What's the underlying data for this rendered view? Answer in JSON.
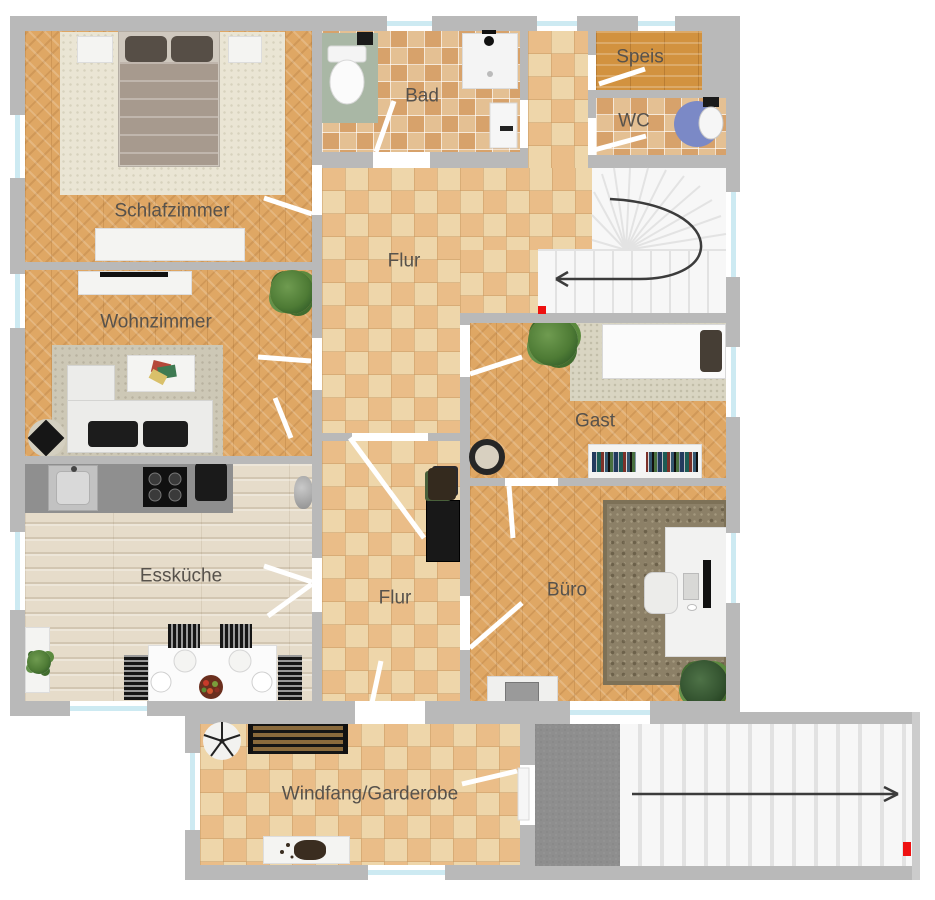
{
  "title": "Erdgeschoss Grundriss",
  "rooms": {
    "schlafzimmer": {
      "label": "Schlafzimmer"
    },
    "wohnzimmer": {
      "label": "Wohnzimmer"
    },
    "esskueche": {
      "label": "Essküche"
    },
    "flur_oben": {
      "label": "Flur"
    },
    "flur_unten": {
      "label": "Flur"
    },
    "bad": {
      "label": "Bad"
    },
    "speis": {
      "label": "Speis"
    },
    "wc": {
      "label": "WC"
    },
    "gast": {
      "label": "Gast"
    },
    "buero": {
      "label": "Büro"
    },
    "windfang": {
      "label": "Windfang/Garderobe"
    }
  },
  "stairs": {
    "upper": {
      "icon": "curved-arrow-left",
      "marker": "red-entry-marker"
    },
    "lower": {
      "icon": "arrow-right",
      "marker": "red-entry-marker"
    }
  },
  "colors": {
    "wall": "#b9b9b9",
    "wall_light": "#cccccc",
    "window_glass": "#cdeaf2",
    "floor_tile_light": "#eed6aa",
    "floor_tile_dark": "#eabd88",
    "bath_tile_light": "#e4c093",
    "bath_tile_dark": "#d7a26b",
    "herringbone_base": "#dfa764",
    "kitchen_plank": "#e6dcca",
    "speis_wood": "#d2923f",
    "stair_tread": "#f7f7f7",
    "stair_edge": "#e2e2e2",
    "landing_gray": "#8e8e8e",
    "arrow": "#3c3c3c",
    "marker_red": "#ee1111",
    "label_text": "#57524c"
  }
}
